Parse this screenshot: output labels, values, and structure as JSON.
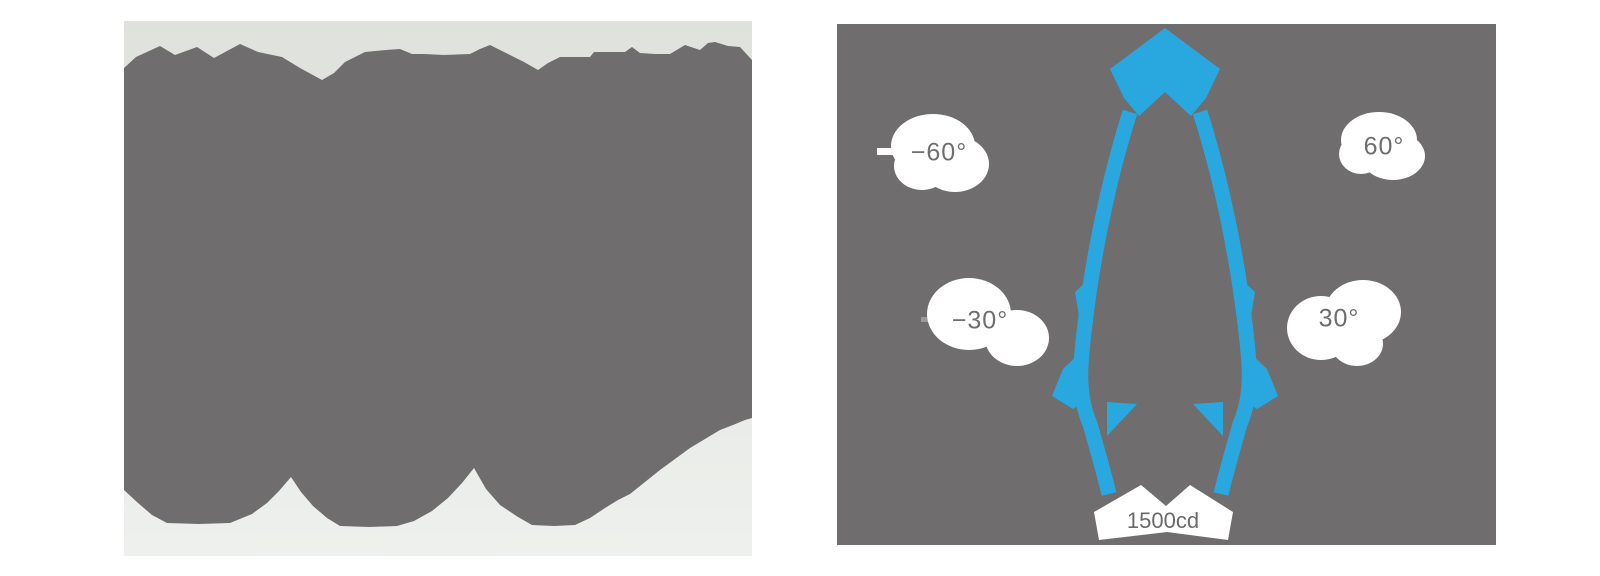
{
  "page": {
    "background_color": "#ffffff"
  },
  "left_figure": {
    "description": "posterized grayscale product image (dark silhouette with finned top edge and three scalloped arcs at bottom)",
    "background_color": "#e4e6e3",
    "silhouette_color": "#6f6d6e"
  },
  "photometric_chart": {
    "background_color": "#6f6d6e",
    "beam_color": "#29a8e0",
    "label_text_color": "#6f6d6e",
    "label_bubble_color": "#ffffff",
    "labels": {
      "neg60": "−60°",
      "neg30": "−30°",
      "pos30": "30°",
      "pos60": "60°",
      "intensity": "1500cd"
    }
  },
  "chart_data": {
    "type": "polar",
    "subtype": "luminous-intensity-distribution (photometric diagram)",
    "title": "",
    "angle_ticks": [
      {
        "angle_deg": -60,
        "label": "−60°"
      },
      {
        "angle_deg": -30,
        "label": "−30°"
      },
      {
        "angle_deg": 30,
        "label": "30°"
      },
      {
        "angle_deg": 60,
        "label": "60°"
      }
    ],
    "radial_tick_labels": [
      "1500cd"
    ],
    "series": [
      {
        "name": "intensity curve",
        "color": "#29a8e0",
        "description": "narrow symmetric beam centered on the 0° vertical axis, peak intensity near 1500 cd at nadir, thick curve legs nearly vertical with small side lobes near ±15–20°",
        "approx_points_deg_relative_intensity": [
          {
            "angle_deg": -20,
            "relative": 0.15
          },
          {
            "angle_deg": -15,
            "relative": 0.35
          },
          {
            "angle_deg": -10,
            "relative": 0.7
          },
          {
            "angle_deg": -5,
            "relative": 0.95
          },
          {
            "angle_deg": 0,
            "relative": 1.0
          },
          {
            "angle_deg": 5,
            "relative": 0.95
          },
          {
            "angle_deg": 10,
            "relative": 0.7
          },
          {
            "angle_deg": 15,
            "relative": 0.35
          },
          {
            "angle_deg": 20,
            "relative": 0.15
          }
        ]
      }
    ],
    "grid": "off",
    "legend": "off"
  }
}
